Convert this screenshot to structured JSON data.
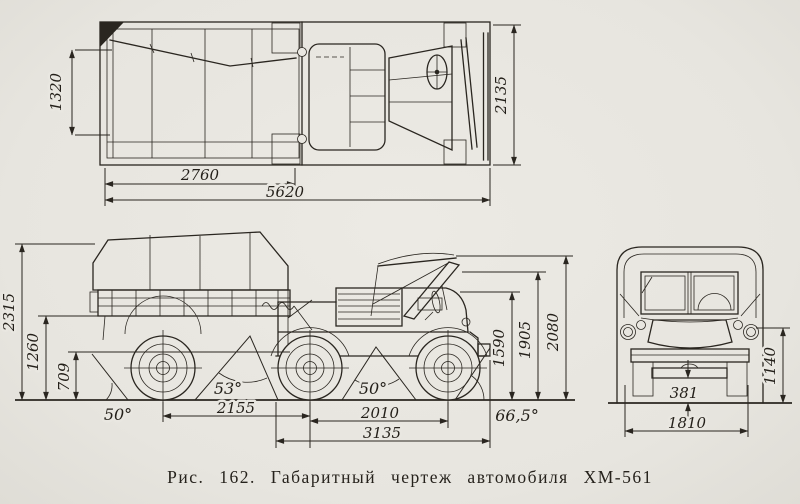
{
  "figure": {
    "caption": "Рис. 162. Габаритный чертеж автомобиля ХМ-561"
  },
  "top_view": {
    "inner_width": "1320",
    "bed_length": "2760",
    "overall_length": "5620",
    "overall_width": "2135"
  },
  "side_view": {
    "trailer_height": "2315",
    "floor_height": "1260",
    "hitch_height": "709",
    "departure_angle": "50°",
    "rear_ramp_angle": "53°",
    "rear_wheelbase": "2155",
    "front_wheelbase": "2010",
    "tractor_length": "3135",
    "front_ramp_angle": "50°",
    "approach_angle": "66,5°",
    "hood_height": "1590",
    "windshield_height": "1905",
    "overall_height": "2080"
  },
  "front_view": {
    "ground_clearance": "381",
    "track": "1810",
    "fender_height": "1140"
  }
}
